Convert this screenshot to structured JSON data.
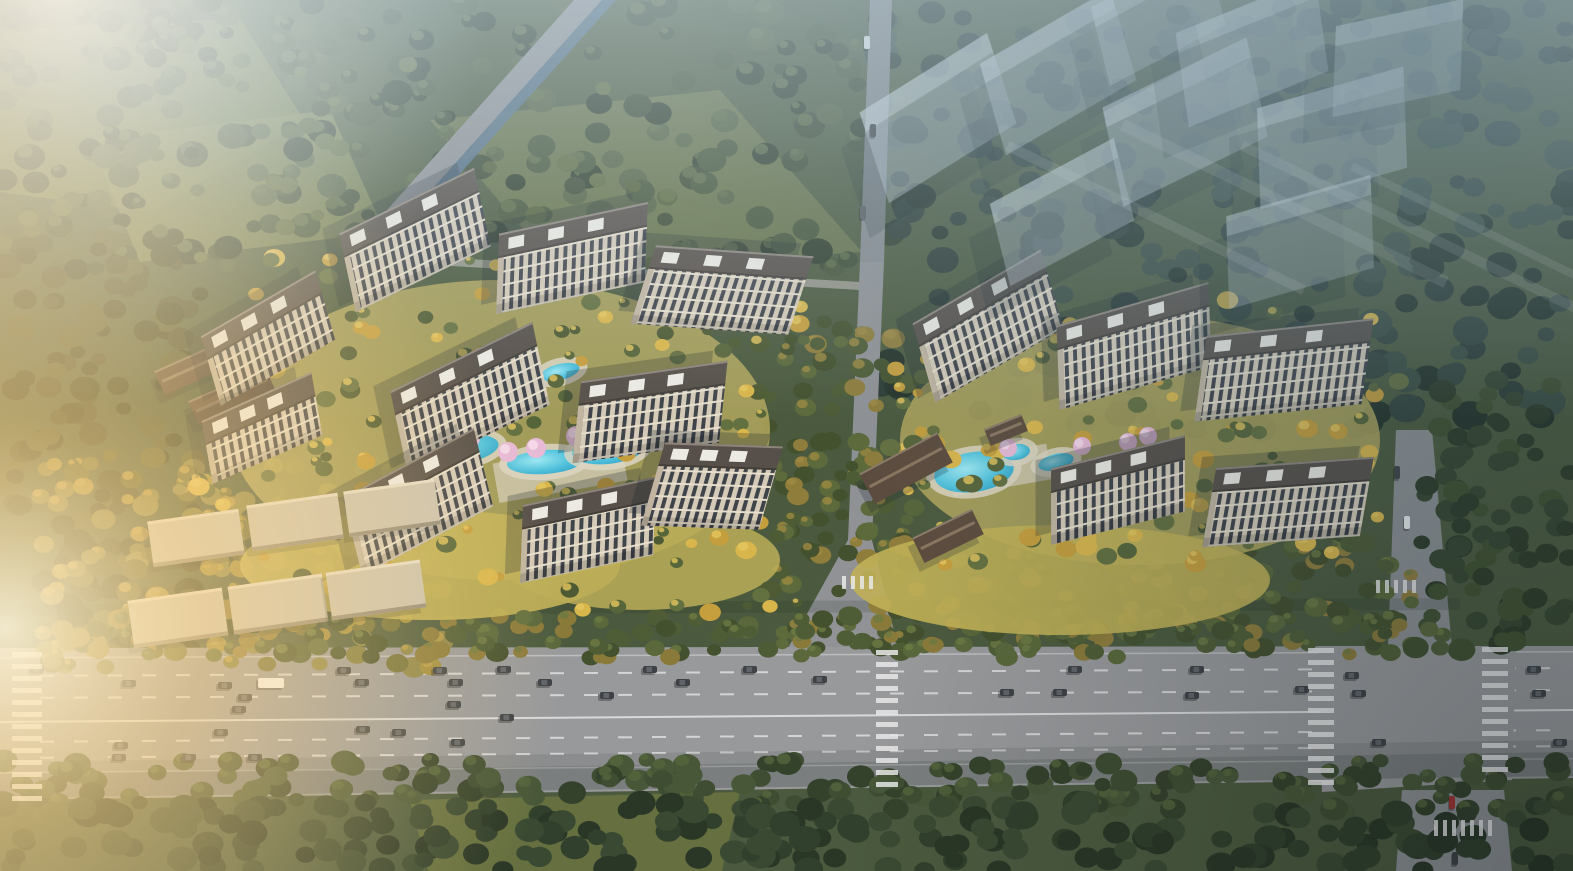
{
  "meta": {
    "description": "Aerial architectural rendering of a residential development: two sunlit high-rise apartment clusters with landscaped water gardens, a translucent future-phase building massing at upper right, surrounding forest, and a wide multi-lane boulevard with traffic along the bottom.",
    "type": "architectural-aerial-rendering",
    "visible_text": ""
  },
  "palette": {
    "base_forest": "#4b5a3e",
    "asphalt": "#98999b",
    "asphalt_shaded": "#8d9093",
    "canal_water": "#51708d",
    "facade": "#d5cab7",
    "window": "#3f434a",
    "roof": "#57504a",
    "roof_parapet": "#3b3632",
    "roof_white_box": "#eceae3",
    "dark_gate_roof": "#5d4c3e",
    "gate_ridge": "#8a7660",
    "pool_water": "#55c4dd",
    "pool_deck": "#dcd5c2",
    "blossom": "#e7bad6",
    "gold_tree": "#c59e3d",
    "green_tree": "#57653a",
    "lane_line": "#e8e8e8",
    "ghost_building": "#c9d6e1",
    "shadow": "#16222c",
    "sun_glare": "#ffd98f",
    "haze": "#c5d6e0"
  },
  "scene": {
    "canvas": {
      "w": 1573,
      "h": 871
    },
    "base_color": "#4b5a3e",
    "meadows": [
      {
        "name": "meadow-top-left",
        "points": "0,30 240,18 305,122 150,212 0,192",
        "color": "#6f7a48",
        "opacity": 0.9
      },
      {
        "name": "meadow-top-left-2",
        "points": "90,140 330,110 385,232 140,262",
        "color": "#7a8350",
        "opacity": 0.8
      },
      {
        "name": "meadow-top-center",
        "points": "430,120 720,90 862,252 560,272",
        "color": "#69744a",
        "opacity": 0.9
      },
      {
        "name": "meadow-bottom",
        "points": "410,800 740,792 722,871 428,871",
        "color": "#68713f",
        "opacity": 0.9
      }
    ],
    "forest_bands": [
      {
        "name": "top-left-forest",
        "x": 0,
        "y": 0,
        "w": 900,
        "h": 270,
        "n": 250,
        "rmin": 7,
        "rmax": 16,
        "seed": 11,
        "colors": [
          "#3c4a33",
          "#455438",
          "#2f3d2b",
          "#526040"
        ],
        "hl": "#5c6b45"
      },
      {
        "name": "top-right-forest",
        "x": 880,
        "y": 0,
        "w": 693,
        "h": 430,
        "n": 300,
        "rmin": 8,
        "rmax": 18,
        "seed": 22,
        "colors": [
          "#2c3b34",
          "#33443c",
          "#253329",
          "#3a4c41"
        ],
        "hl": ""
      },
      {
        "name": "left-forest",
        "x": 0,
        "y": 230,
        "w": 200,
        "h": 430,
        "n": 140,
        "rmin": 7,
        "rmax": 15,
        "seed": 33,
        "colors": [
          "#42492f",
          "#374028",
          "#4f5735"
        ],
        "hl": ""
      },
      {
        "name": "autumn-lowrise-grove",
        "x": 40,
        "y": 455,
        "w": 410,
        "h": 215,
        "n": 180,
        "rmin": 6,
        "rmax": 13,
        "seed": 44,
        "colors": [
          "#6f6f3a",
          "#7d7a40",
          "#8a8448",
          "#a08c3e",
          "#5d6133"
        ],
        "hl": "#b89c48"
      },
      {
        "name": "boulevard-top-trees",
        "x": 50,
        "y": 616,
        "w": 1410,
        "h": 42,
        "n": 160,
        "rmin": 7,
        "rmax": 12,
        "seed": 55,
        "colors": [
          "#4f5d36",
          "#5a683c",
          "#44512f",
          "#8a7a3a"
        ],
        "hl": "#6d7a44"
      },
      {
        "name": "boulevard-bottom-trees",
        "x": 0,
        "y": 760,
        "w": 1573,
        "h": 52,
        "n": 175,
        "rmin": 8,
        "rmax": 14,
        "seed": 66,
        "colors": [
          "#3f4d32",
          "#485738",
          "#35422b"
        ],
        "hl": "#55653c"
      },
      {
        "name": "bottom-forest",
        "x": 0,
        "y": 802,
        "w": 1573,
        "h": 69,
        "n": 200,
        "rmin": 9,
        "rmax": 16,
        "seed": 77,
        "colors": [
          "#31402c",
          "#2a3726",
          "#3a4a32"
        ],
        "hl": ""
      },
      {
        "name": "mid-gap-trees",
        "x": 768,
        "y": 320,
        "w": 140,
        "h": 330,
        "n": 100,
        "rmin": 6,
        "rmax": 12,
        "seed": 88,
        "colors": [
          "#4e5c35",
          "#5d6a3b",
          "#8f7d3c",
          "#44512e"
        ],
        "hl": "#9d8a42"
      },
      {
        "name": "east-south-park",
        "x": 895,
        "y": 532,
        "w": 520,
        "h": 120,
        "n": 135,
        "rmin": 7,
        "rmax": 12,
        "seed": 99,
        "colors": [
          "#4d5b34",
          "#596739",
          "#8f7d3c",
          "#434f2d"
        ],
        "hl": "#6d7a42"
      },
      {
        "name": "right-forest",
        "x": 1415,
        "y": 380,
        "w": 158,
        "h": 275,
        "n": 80,
        "rmin": 8,
        "rmax": 14,
        "seed": 101,
        "colors": [
          "#36452f",
          "#2e3b28",
          "#40502f"
        ],
        "hl": ""
      },
      {
        "name": "top-meadow-sparse-trees",
        "x": 0,
        "y": 30,
        "w": 700,
        "h": 240,
        "n": 45,
        "rmin": 6,
        "rmax": 11,
        "seed": 103,
        "colors": [
          "#53603a",
          "#5e6b40"
        ],
        "hl": ""
      },
      {
        "name": "west-courtyard-trees",
        "x": 195,
        "y": 255,
        "w": 610,
        "h": 370,
        "n": 155,
        "rmin": 5,
        "rmax": 11,
        "seed": 105,
        "colors": [
          "#57653a",
          "#637040",
          "#c59e3d",
          "#d9b64c",
          "#4d5a33"
        ],
        "hl": "#e4c65e"
      },
      {
        "name": "east-courtyard-trees",
        "x": 885,
        "y": 300,
        "w": 515,
        "h": 265,
        "n": 120,
        "rmin": 5,
        "rmax": 11,
        "seed": 107,
        "colors": [
          "#57653a",
          "#637040",
          "#c59e3d",
          "#d9b64c"
        ],
        "hl": "#e4c65e"
      }
    ],
    "roads": [
      {
        "name": "canal-road",
        "points": "574,0 602,0 372,256 346,256",
        "color": "#8e9094",
        "opacity": 1
      },
      {
        "name": "canal",
        "points": "602,0 616,0 386,256 372,256",
        "color": "#51708d",
        "opacity": 0.85
      },
      {
        "name": "north-boundary-path",
        "points": "348,252 860,282 860,290 348,260",
        "color": "#a5a49a",
        "opacity": 0.8
      },
      {
        "name": "central-road-top",
        "points": "870,0 892,0 884,262 860,262",
        "color": "#878b8f",
        "opacity": 1
      },
      {
        "name": "central-road",
        "points": "860,262 884,262 872,540 898,648 788,648 848,540",
        "color": "#909295",
        "opacity": 1
      },
      {
        "name": "right-road-upper",
        "points": "1396,430 1432,430 1452,648 1388,648",
        "color": "#8d9093",
        "opacity": 1
      },
      {
        "name": "right-road-lower",
        "points": "1402,790 1504,790 1512,871 1396,871",
        "color": "#8d9093",
        "opacity": 1
      }
    ],
    "boulevard": {
      "poly": "0,648 1573,646 1573,778 0,800",
      "color": "#98999b",
      "dashed": [
        [
          675,
          667
        ],
        [
          697,
          689
        ],
        [
          741,
          729
        ],
        [
          757,
          745
        ]
      ],
      "solid": [
        [
          657,
          651
        ],
        [
          772,
          758
        ]
      ],
      "center": [
        721,
        709
      ],
      "dash_len": 14,
      "dash_gap": 20,
      "x0": 40,
      "x1": 1560,
      "line_color": "#e8e8e8"
    },
    "intersection_pad": {
      "points": "1318,646 1516,646 1512,780 1322,792",
      "color": "#98999b"
    },
    "shadow_bands": [
      {
        "points": "0,798 1573,776 1573,752 0,774",
        "color": "#141f18",
        "opacity": 0.22
      },
      {
        "points": "0,774 1573,752 1573,740 0,762",
        "color": "#141f18",
        "opacity": 0.1
      },
      {
        "points": "0,616 1460,610 1460,598 0,604",
        "color": "#1c2a20",
        "opacity": 0.15
      }
    ],
    "clusters": {
      "west": {
        "lawns": [
          {
            "cx": 500,
            "cy": 430,
            "rx": 270,
            "ry": 150,
            "color": "#b2a75e",
            "opacity": 0.85
          },
          {
            "cx": 430,
            "cy": 565,
            "rx": 190,
            "ry": 55,
            "color": "#c2b158",
            "opacity": 0.9
          },
          {
            "cx": 640,
            "cy": 560,
            "rx": 140,
            "ry": 50,
            "color": "#bcae58",
            "opacity": 0.85
          }
        ],
        "plazas": [
          {
            "x": 560,
            "y": 472,
            "w": 130,
            "h": 40,
            "rot": -10,
            "color": "#d6cfbf",
            "opacity": 0.7
          }
        ],
        "pools": [
          [
            455,
            450,
            44,
            15,
            -8
          ],
          [
            545,
            462,
            38,
            12,
            -4
          ],
          [
            608,
            450,
            36,
            14,
            -6
          ],
          [
            641,
            420,
            22,
            11,
            -20
          ],
          [
            560,
            372,
            20,
            8,
            -14
          ],
          [
            488,
            384,
            14,
            7,
            -14
          ]
        ],
        "blossoms": [
          [
            470,
            438
          ],
          [
            508,
            452
          ],
          [
            576,
            436
          ],
          [
            640,
            442
          ],
          [
            700,
            432
          ],
          [
            536,
            448
          ]
        ],
        "gates": [
          [
            600,
            538,
            -16,
            72,
            26
          ],
          [
            198,
            366,
            -24,
            84,
            26
          ],
          [
            232,
            396,
            -24,
            84,
            26
          ]
        ],
        "towers": [
          [
            415,
            240,
            -26,
            150,
            78
          ],
          [
            572,
            258,
            -12,
            152,
            78
          ],
          [
            722,
            290,
            4,
            158,
            80
          ],
          [
            268,
            338,
            -30,
            132,
            70
          ],
          [
            470,
            398,
            -26,
            158,
            82
          ],
          [
            650,
            412,
            -8,
            148,
            80
          ],
          [
            262,
            428,
            -24,
            120,
            62
          ],
          [
            418,
            502,
            -28,
            148,
            78
          ],
          [
            588,
            530,
            -12,
            136,
            76
          ],
          [
            712,
            486,
            2,
            118,
            84
          ]
        ]
      },
      "east": {
        "lawns": [
          {
            "cx": 1140,
            "cy": 440,
            "rx": 240,
            "ry": 125,
            "color": "#b2a75e",
            "opacity": 0.85
          },
          {
            "cx": 1060,
            "cy": 580,
            "rx": 210,
            "ry": 55,
            "color": "#c0b056",
            "opacity": 0.9
          }
        ],
        "plazas": [
          {
            "x": 1000,
            "y": 470,
            "w": 100,
            "h": 36,
            "rot": -10,
            "color": "#d6cfbf",
            "opacity": 0.7
          }
        ],
        "pools": [
          [
            974,
            472,
            40,
            20,
            -8
          ],
          [
            1016,
            452,
            14,
            8,
            -8
          ],
          [
            1056,
            462,
            18,
            8,
            -14
          ]
        ],
        "blossoms": [
          [
            1008,
            448
          ],
          [
            1082,
            446
          ],
          [
            1128,
            442
          ],
          [
            1148,
            436
          ]
        ],
        "gates": [
          [
            906,
            468,
            -28,
            88,
            34
          ],
          [
            948,
            536,
            -26,
            66,
            28
          ],
          [
            1006,
            430,
            -22,
            40,
            18
          ]
        ],
        "towers": [
          [
            988,
            326,
            -30,
            148,
            80
          ],
          [
            1134,
            346,
            -16,
            158,
            82
          ],
          [
            1284,
            370,
            -6,
            168,
            84
          ],
          [
            1118,
            490,
            -14,
            138,
            74
          ],
          [
            1288,
            502,
            -4,
            158,
            78
          ]
        ]
      }
    },
    "low_rise_rows": [
      [
        196,
        538,
        92,
        46,
        -8
      ],
      [
        295,
        522,
        92,
        46,
        -8
      ],
      [
        392,
        508,
        92,
        46,
        -8
      ],
      [
        178,
        618,
        95,
        48,
        -8
      ],
      [
        278,
        604,
        95,
        48,
        -8
      ],
      [
        376,
        590,
        95,
        48,
        -8
      ]
    ],
    "low_rise_style": {
      "top": "#cbc3b0",
      "hl": "#e6ddc8",
      "edge": "#958d7c"
    },
    "ghost_towers": [
      [
        938,
        118,
        -32,
        150,
        92,
        0.4
      ],
      [
        1058,
        72,
        -30,
        150,
        92,
        0.38
      ],
      [
        1185,
        122,
        -26,
        160,
        98,
        0.42
      ],
      [
        1062,
        212,
        -28,
        140,
        82,
        0.36
      ],
      [
        1252,
        52,
        -22,
        150,
        92,
        0.38
      ],
      [
        1332,
        138,
        -16,
        152,
        98,
        0.4
      ],
      [
        1398,
        58,
        -12,
        130,
        88,
        0.34
      ],
      [
        1158,
        16,
        -28,
        130,
        78,
        0.32
      ],
      [
        1300,
        242,
        -16,
        150,
        90,
        0.3
      ]
    ],
    "ghost_streaks": [
      [
        1005,
        150,
        330,
        10,
        -64
      ],
      [
        1120,
        130,
        360,
        12,
        -64
      ],
      [
        1240,
        150,
        380,
        10,
        -64
      ],
      [
        1350,
        170,
        330,
        8,
        -64
      ]
    ],
    "cars": [
      [
        30,
        666
      ],
      [
        122,
        680
      ],
      [
        218,
        682
      ],
      [
        238,
        694
      ],
      [
        232,
        706
      ],
      [
        214,
        729
      ],
      [
        114,
        742
      ],
      [
        112,
        754
      ],
      [
        182,
        754
      ],
      [
        248,
        754
      ],
      [
        258,
        678,
        26,
        10,
        "#f2f4f4"
      ],
      [
        337,
        667
      ],
      [
        355,
        679
      ],
      [
        356,
        726
      ],
      [
        392,
        729
      ],
      [
        433,
        667
      ],
      [
        449,
        679
      ],
      [
        447,
        701
      ],
      [
        451,
        739
      ],
      [
        497,
        666
      ],
      [
        500,
        714
      ],
      [
        538,
        679
      ],
      [
        600,
        692
      ],
      [
        643,
        666
      ],
      [
        676,
        679
      ],
      [
        743,
        666
      ],
      [
        813,
        676
      ],
      [
        1000,
        689
      ],
      [
        1053,
        689
      ],
      [
        1068,
        666
      ],
      [
        1185,
        692
      ],
      [
        1190,
        666
      ],
      [
        1295,
        686
      ],
      [
        1345,
        672
      ],
      [
        1352,
        690
      ],
      [
        1372,
        739
      ],
      [
        1527,
        666
      ],
      [
        1532,
        690
      ],
      [
        1553,
        739
      ]
    ],
    "cars_vertical": [
      [
        864,
        36,
        "#eceeee"
      ],
      [
        870,
        124,
        "#3f4347"
      ],
      [
        860,
        206,
        "#565b60"
      ],
      [
        1404,
        516,
        "#eceeee"
      ],
      [
        1394,
        466,
        "#3f4347"
      ],
      [
        1449,
        796,
        "#a23434"
      ],
      [
        1452,
        852,
        "#3f4347"
      ]
    ],
    "car_default_color": "#3e4247",
    "crosswalks": {
      "v": [
        [
          12,
          652,
          146,
          30
        ],
        [
          876,
          650,
          142,
          22
        ],
        [
          1308,
          648,
          142,
          26
        ],
        [
          1482,
          647,
          132,
          26
        ]
      ],
      "h": [
        [
          1376,
          580,
          44,
          13
        ],
        [
          842,
          576,
          34,
          13
        ],
        [
          1434,
          820,
          56,
          16
        ]
      ],
      "stripe": 5,
      "gap": 7,
      "color": "#e9e9e9"
    },
    "tower_style": {
      "facade": "#d5cab7",
      "window": "#3f434a",
      "floor_line": "#e7dfcc",
      "roof": "#57504a",
      "roof_edge": "#8d857c",
      "parapet": "#3b3632",
      "white_box": "#eceae3",
      "end_wall": "#c1b5a1",
      "shadow": "#16222c",
      "ghost_fill": "#c9d6e1",
      "ghost_roof": "#dde7ee"
    },
    "atmosphere": {
      "haze_top": "#c5d6e0",
      "cool_tr": "#3f6070",
      "glare_tl": "#f6fcff",
      "warm_left": "#ffcf8e",
      "sun_core": "#fff6da",
      "sun_mid": "#ffd98f",
      "vignette_br": "#0a141a",
      "water_light": "#9fe8f2",
      "water_mid": "#55c4dd",
      "water_deep": "#2fa3c8"
    }
  }
}
